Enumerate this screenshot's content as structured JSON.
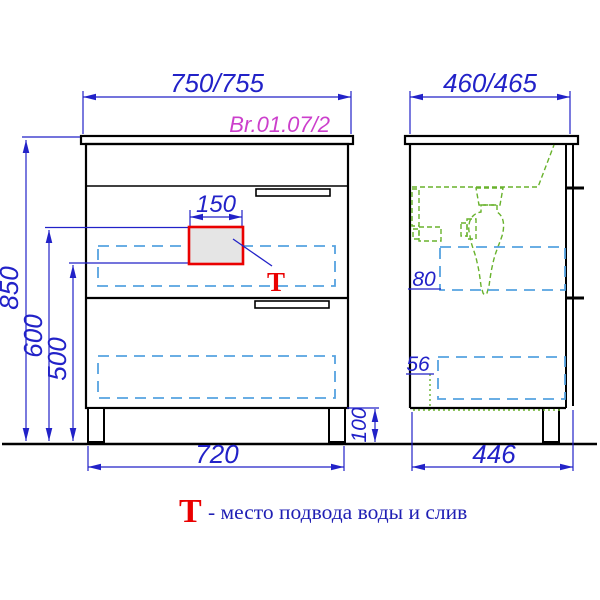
{
  "drawing": {
    "code": "Br.01.07/2",
    "front_view": {
      "dim_width": "750/755",
      "dim_height": "850",
      "dim_600": "600",
      "dim_500": "500",
      "dim_150": "150",
      "dim_720": "720",
      "dim_100": "100",
      "marker_t": "Т"
    },
    "side_view": {
      "dim_depth": "460/465",
      "dim_80": "80",
      "dim_56": "56",
      "dim_446": "446"
    },
    "legend": {
      "symbol": "Т",
      "text": "- место подвода воды и слив"
    },
    "colors": {
      "dimension_blue": "#2222c8",
      "dashed_blue": "#55a2e0",
      "plumbing_green": "#68b22c",
      "highlight_red": "#ea0000",
      "code_magenta": "#cc3fcc",
      "outline_black": "#000000"
    }
  }
}
